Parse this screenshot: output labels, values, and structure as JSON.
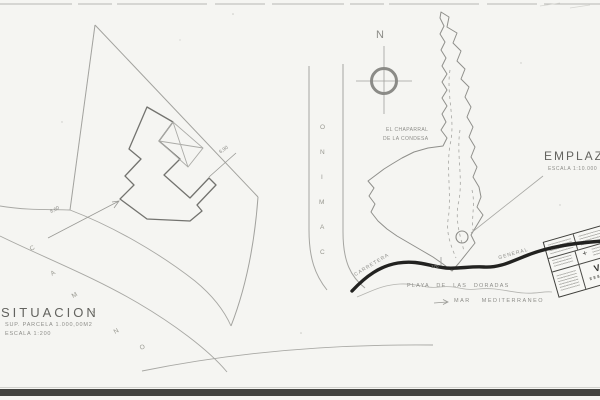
{
  "page": {
    "background": "#f5f5f2",
    "line_color": "#9a9a96",
    "ink_color": "#222220"
  },
  "situacion": {
    "title": "SITUACION",
    "parcel_area": "SUP. PARCELA 1.000,00M2",
    "scale": "ESCALA 1:200",
    "dim_right": "6,90",
    "dim_left": "8,60",
    "road_letters": [
      "C",
      "A",
      "M",
      "I",
      "N",
      "O"
    ]
  },
  "emplazamiento": {
    "title": "EMPLAZAMIENTO",
    "scale": "ESCALA 1:10.000",
    "north_label": "N",
    "area_line1": "EL CHAPARRAL",
    "area_line2": "DE LA CONDESA",
    "beach_label": "PLAYA DE LAS DORADAS",
    "sea_label": "MAR MEDITERRANEO",
    "road_label_left": "CARRETERA",
    "road_label_right": "GENERAL",
    "km_marker": "170",
    "camino_letters": [
      "O",
      "N",
      "I",
      "M",
      "A",
      "C"
    ]
  },
  "stamp": {
    "visa_label": "VISA",
    "mark": "+"
  }
}
